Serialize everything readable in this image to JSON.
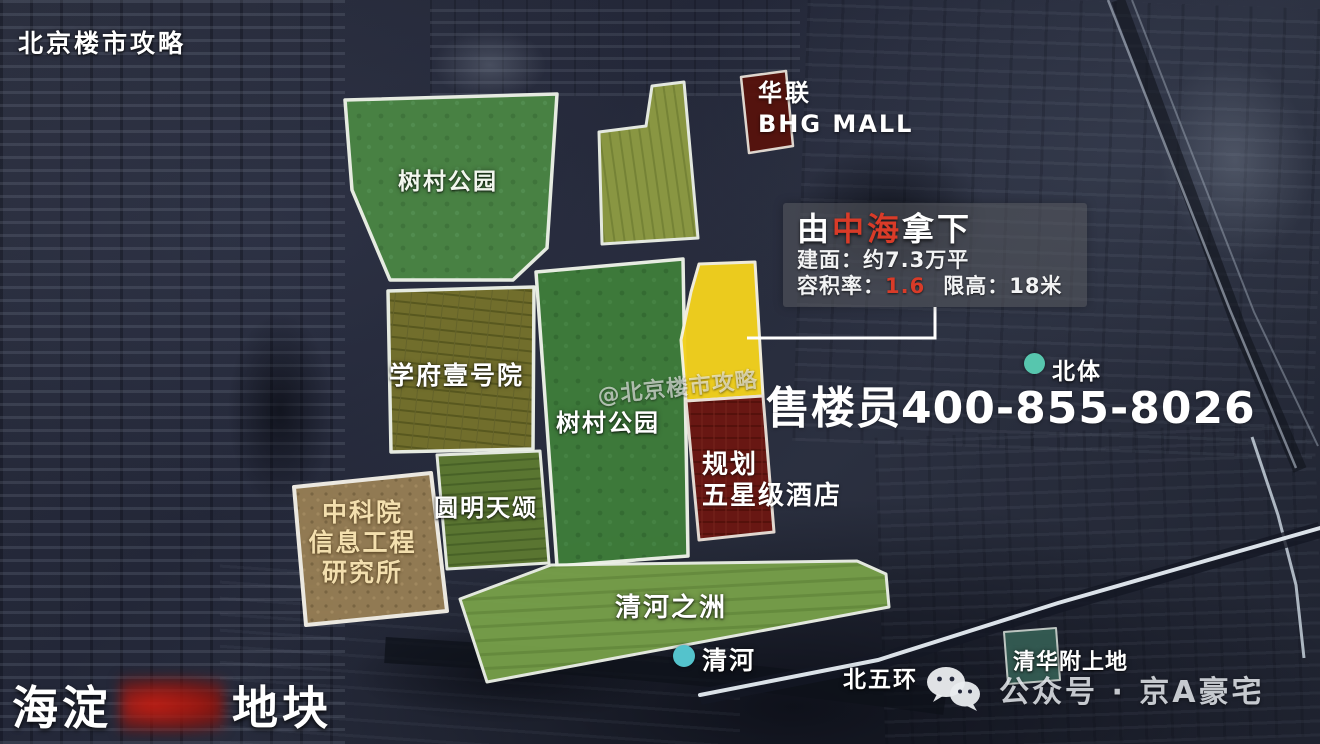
{
  "watermarks": {
    "top_left": "北京楼市攻略",
    "center": "@北京楼市攻略"
  },
  "phone_overlay": "售楼员400-855-8026",
  "callout": {
    "title_prefix": "由",
    "title_highlight": "中海",
    "title_suffix": "拿下",
    "area_line": "建面：约7.3万平",
    "far_label": "容积率：",
    "far_value": "1.6",
    "height_label": "限高：",
    "height_value": "18米"
  },
  "parcels": {
    "park_top": {
      "label": "树村公园"
    },
    "park_center": {
      "label": "树村公园"
    },
    "xuefu": {
      "label": "学府壹号院"
    },
    "yuanming": {
      "label": "圆明天颂"
    },
    "cas": {
      "line1": "中科院",
      "line2": "信息工程",
      "line3": "研究所"
    },
    "hotel": {
      "line1": "规划",
      "line2": "五星级酒店"
    },
    "qinghe_strip": {
      "label": "清河之洲"
    },
    "bhg": {
      "line1": "华联",
      "line2": "BHG MALL"
    },
    "qinghua": {
      "label": "清华附上地"
    }
  },
  "pois": {
    "beiti": "北体",
    "qinghe_river": "清河",
    "beiwuhuan": "北五环"
  },
  "title": {
    "prefix": "海淀",
    "suffix": "地块"
  },
  "footer": {
    "wechat_label": "公众号 · 京A豪宅"
  },
  "colors": {
    "highlight_red": "#d93b28",
    "parcel_yellow": "#f2d11d",
    "parcel_park_green": "#3e7c3a",
    "parcel_hotel_maroon": "#6b1712",
    "river_dot_cyan": "#54c3cc",
    "beiti_dot_teal": "#57c6ae"
  }
}
